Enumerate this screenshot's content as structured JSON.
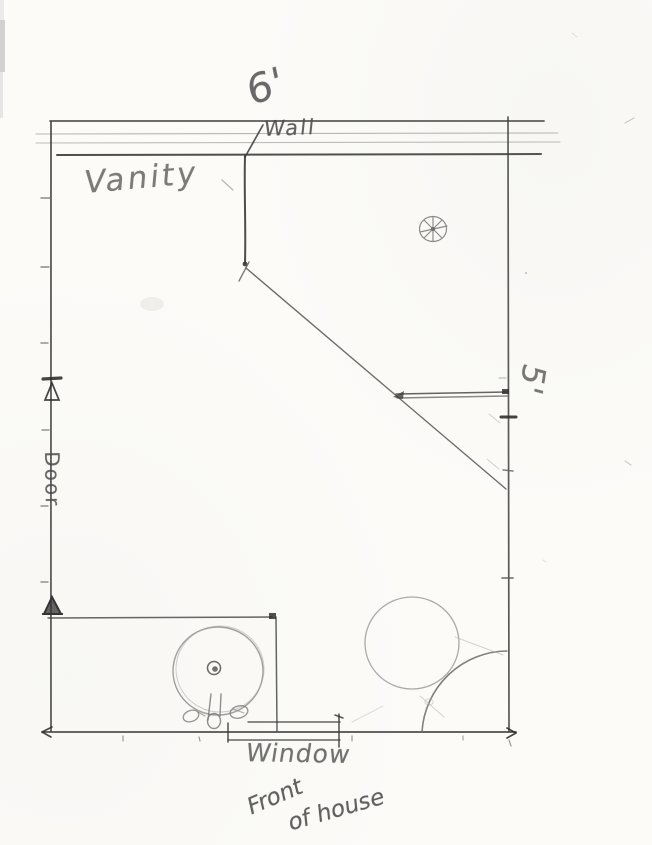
{
  "labels": {
    "top_dimension": "6'",
    "wall": "Wall",
    "vanity": "Vanity",
    "right_dimension": "5'",
    "door": "Door",
    "window": "Window",
    "front_of_house_line1": "Front",
    "front_of_house_line2": "of house"
  },
  "symbols": {
    "ceiling_light": "circle-with-8-point-star",
    "door_jamb_markers": "triangle-markers",
    "pedestal_sink": "circle-with-center-drain-and-faucet",
    "corner_fixture": "large-circle-with-corner-arc"
  },
  "colors": {
    "paper": "#fcfbf8",
    "pencil_dark": "#3c3c3c",
    "pencil_mid": "#7a7a7a",
    "pencil_light": "#a8a8a8"
  }
}
